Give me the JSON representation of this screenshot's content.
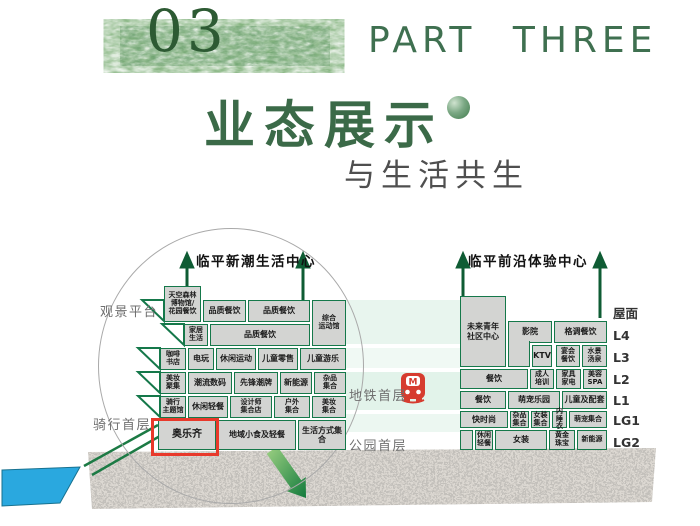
{
  "header": {
    "part_number": "03",
    "part_label": "PART THREE",
    "title": "业态展示",
    "subtitle": "与生活共生"
  },
  "colors": {
    "brand_green": "#3b6a48",
    "cell_border": "#15784a",
    "cell_fill": "#d3d4d2",
    "highlight_red": "#e8392b",
    "metro_red": "#d63c2f",
    "water_blue": "#2aa8df"
  },
  "diagram": {
    "floor_labels": [
      {
        "text": "屋面",
        "x": 613,
        "y": 303
      },
      {
        "text": "L4",
        "x": 613,
        "y": 328
      },
      {
        "text": "L3",
        "x": 613,
        "y": 350
      },
      {
        "text": "L2",
        "x": 613,
        "y": 372
      },
      {
        "text": "L1",
        "x": 613,
        "y": 393
      },
      {
        "text": "LG1",
        "x": 613,
        "y": 413
      },
      {
        "text": "LG2",
        "x": 613,
        "y": 435
      }
    ],
    "side_labels": [
      {
        "text": "观景平台",
        "x": 100,
        "y": 301
      },
      {
        "text": "骑行首层",
        "x": 93,
        "y": 414
      },
      {
        "text": "地铁首层",
        "x": 349,
        "y": 385
      },
      {
        "text": "公园首层",
        "x": 349,
        "y": 435
      }
    ],
    "buildings": [
      {
        "name": "临平新潮生活中心",
        "title": {
          "cx": 256,
          "y": 250
        },
        "cells": [
          {
            "label": "天空森林\n博物馆/\n花园餐饮",
            "x": 164,
            "y": 286,
            "w": 37,
            "h": 36,
            "cls": "tiny"
          },
          {
            "label": "品质餐饮",
            "x": 203,
            "y": 300,
            "w": 43,
            "h": 22
          },
          {
            "label": "品质餐饮",
            "x": 248,
            "y": 300,
            "w": 62,
            "h": 22
          },
          {
            "label": "综合\n运动馆",
            "x": 312,
            "y": 300,
            "w": 34,
            "h": 46,
            "cls": "tiny"
          },
          {
            "label": "家居\n生活",
            "x": 184,
            "y": 324,
            "w": 24,
            "h": 22,
            "cls": "tiny"
          },
          {
            "label": "品质餐饮",
            "x": 210,
            "y": 324,
            "w": 100,
            "h": 22
          },
          {
            "label": "咖啡\n书店",
            "x": 160,
            "y": 348,
            "w": 26,
            "h": 22,
            "cls": "tiny"
          },
          {
            "label": "电玩",
            "x": 188,
            "y": 348,
            "w": 26,
            "h": 22
          },
          {
            "label": "休闲运动",
            "x": 216,
            "y": 348,
            "w": 40,
            "h": 22
          },
          {
            "label": "儿童零售",
            "x": 258,
            "y": 348,
            "w": 40,
            "h": 22
          },
          {
            "label": "儿童游乐",
            "x": 300,
            "y": 348,
            "w": 46,
            "h": 22
          },
          {
            "label": "美妆\n聚集",
            "x": 160,
            "y": 372,
            "w": 26,
            "h": 22,
            "cls": "tiny"
          },
          {
            "label": "潮流数码",
            "x": 188,
            "y": 372,
            "w": 44,
            "h": 22
          },
          {
            "label": "先锋潮牌",
            "x": 234,
            "y": 372,
            "w": 44,
            "h": 22
          },
          {
            "label": "新能源",
            "x": 280,
            "y": 372,
            "w": 32,
            "h": 22
          },
          {
            "label": "杂品\n集合",
            "x": 314,
            "y": 372,
            "w": 32,
            "h": 22,
            "cls": "tiny"
          },
          {
            "label": "骑行\n主题馆",
            "x": 160,
            "y": 396,
            "w": 26,
            "h": 22,
            "cls": "tiny"
          },
          {
            "label": "休闲轻餐",
            "x": 188,
            "y": 396,
            "w": 40,
            "h": 22
          },
          {
            "label": "设计师\n集合店",
            "x": 230,
            "y": 396,
            "w": 42,
            "h": 22,
            "cls": "tiny"
          },
          {
            "label": "户外\n集合",
            "x": 274,
            "y": 396,
            "w": 36,
            "h": 22,
            "cls": "tiny"
          },
          {
            "label": "美妆\n集合",
            "x": 312,
            "y": 396,
            "w": 34,
            "h": 22,
            "cls": "tiny"
          },
          {
            "label": "奥乐齐",
            "x": 158,
            "y": 420,
            "w": 58,
            "h": 30,
            "cls": "big"
          },
          {
            "label": "地域小食及轻餐",
            "x": 218,
            "y": 420,
            "w": 78,
            "h": 30
          },
          {
            "label": "生活方式集合",
            "x": 298,
            "y": 420,
            "w": 48,
            "h": 30
          }
        ]
      },
      {
        "name": "临平前沿体验中心",
        "title": {
          "cx": 528,
          "y": 250
        },
        "cells": [
          {
            "label": "未来青年\n社区中心",
            "x": 460,
            "y": 296,
            "w": 46,
            "h": 71
          },
          {
            "label": "影院",
            "x": 508,
            "y": 321,
            "w": 44,
            "h": 22
          },
          {
            "label": "",
            "x": 508,
            "y": 341,
            "w": 22,
            "h": 26,
            "cls": "noTop"
          },
          {
            "label": "KTV",
            "x": 532,
            "y": 345,
            "w": 20,
            "h": 22
          },
          {
            "label": "格调餐饮",
            "x": 554,
            "y": 321,
            "w": 53,
            "h": 22
          },
          {
            "label": "宴会\n餐饮",
            "x": 556,
            "y": 345,
            "w": 24,
            "h": 22,
            "cls": "tiny"
          },
          {
            "label": "水景\n汤泉",
            "x": 582,
            "y": 345,
            "w": 25,
            "h": 22,
            "cls": "tiny"
          },
          {
            "label": "餐饮",
            "x": 460,
            "y": 369,
            "w": 68,
            "h": 20
          },
          {
            "label": "成人\n培训",
            "x": 530,
            "y": 369,
            "w": 24,
            "h": 20,
            "cls": "tiny"
          },
          {
            "label": "家具\n家电",
            "x": 556,
            "y": 369,
            "w": 25,
            "h": 20,
            "cls": "tiny"
          },
          {
            "label": "美容\nSPA",
            "x": 583,
            "y": 369,
            "w": 24,
            "h": 20,
            "cls": "tiny"
          },
          {
            "label": "餐饮",
            "x": 460,
            "y": 391,
            "w": 46,
            "h": 18
          },
          {
            "label": "萌宠乐园",
            "x": 508,
            "y": 391,
            "w": 52,
            "h": 18
          },
          {
            "label": "儿童及配套",
            "x": 562,
            "y": 391,
            "w": 45,
            "h": 18
          },
          {
            "label": "快时尚",
            "x": 460,
            "y": 411,
            "w": 48,
            "h": 17
          },
          {
            "label": "杂品\n集合",
            "x": 510,
            "y": 411,
            "w": 19,
            "h": 17,
            "cls": "tiny"
          },
          {
            "label": "女装\n集合",
            "x": 531,
            "y": 411,
            "w": 19,
            "h": 17,
            "cls": "tiny"
          },
          {
            "label": "内\n睡衣",
            "x": 552,
            "y": 411,
            "w": 15,
            "h": 17,
            "cls": "tiny"
          },
          {
            "label": "萌宠集合",
            "x": 569,
            "y": 411,
            "w": 38,
            "h": 17,
            "cls": "tiny"
          },
          {
            "label": "",
            "x": 460,
            "y": 430,
            "w": 13,
            "h": 20
          },
          {
            "label": "休闲\n轻餐",
            "x": 475,
            "y": 430,
            "w": 18,
            "h": 20,
            "cls": "tiny"
          },
          {
            "label": "女装",
            "x": 495,
            "y": 430,
            "w": 52,
            "h": 20
          },
          {
            "label": "黄金\n珠宝",
            "x": 549,
            "y": 430,
            "w": 26,
            "h": 20,
            "cls": "tiny"
          },
          {
            "label": "新能源",
            "x": 577,
            "y": 430,
            "w": 30,
            "h": 20,
            "cls": "tiny"
          }
        ]
      }
    ],
    "highlight": {
      "label": "奥乐齐",
      "x": 151,
      "y": 418,
      "w": 68,
      "h": 38
    },
    "metro_icon_label": "M"
  }
}
